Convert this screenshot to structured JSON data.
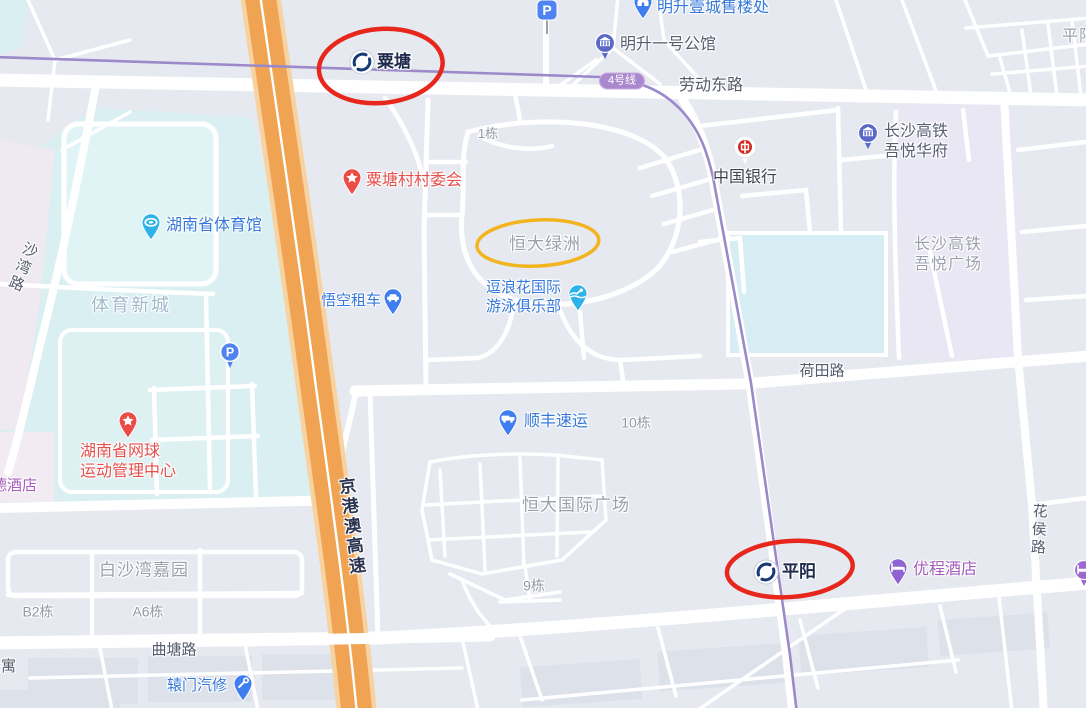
{
  "metro": {
    "line_badge": {
      "text": "4号线",
      "x": 622,
      "y": 81
    },
    "stations": [
      {
        "id": "station-sutang",
        "name": "粟塘",
        "icon_x": 362,
        "icon_y": 62,
        "text_x": 377,
        "text_y": 51,
        "fs": 17
      },
      {
        "id": "station-pingyang",
        "name": "平阳",
        "icon_x": 766,
        "icon_y": 572,
        "text_x": 782,
        "text_y": 561,
        "fs": 17
      }
    ]
  },
  "labels": [
    {
      "id": "road-laodongdonglu",
      "text": "劳动东路",
      "x": 711,
      "y": 86,
      "cls": "road",
      "fs": 16,
      "anchor": "center"
    },
    {
      "id": "road-hetianlu",
      "text": "荷田路",
      "x": 822,
      "y": 372,
      "cls": "road",
      "fs": 15,
      "anchor": "center"
    },
    {
      "id": "road-qutanglu",
      "text": "曲塘路",
      "x": 174,
      "y": 651,
      "cls": "road",
      "fs": 15,
      "anchor": "center"
    },
    {
      "id": "road-shawanlu",
      "text": "沙湾路",
      "x": 12,
      "y": 240,
      "cls": "road",
      "fs": 15,
      "vertical": true,
      "rotate": 22
    },
    {
      "id": "road-huahoulu",
      "text": "花侯路",
      "x": 1028,
      "y": 503,
      "cls": "road",
      "fs": 15,
      "vertical": true,
      "rotate": 3
    },
    {
      "id": "road-jinggangao-expressway",
      "text": "京港澳高速",
      "x": 340,
      "y": 477,
      "cls": "hwy",
      "fs": 17,
      "vertical": true,
      "rotate": -7
    },
    {
      "id": "label-gongyu-partial",
      "text": "公寓",
      "x": -14,
      "y": 658,
      "cls": "road",
      "fs": 15
    },
    {
      "id": "area-tiyuxincheng",
      "text": "体育新城",
      "x": 131,
      "y": 305,
      "cls": "sports",
      "fs": 18,
      "anchor": "center"
    },
    {
      "id": "area-baishawan-jiayuan",
      "text": "白沙湾嘉园",
      "x": 144,
      "y": 570,
      "cls": "area",
      "fs": 17,
      "anchor": "center"
    },
    {
      "id": "area-hengda-lvzhou",
      "text": "恒大绿洲",
      "x": 545,
      "y": 244,
      "cls": "area",
      "fs": 17,
      "anchor": "center"
    },
    {
      "id": "area-hengda-guoji-guangchang",
      "text": "恒大国际广场",
      "x": 576,
      "y": 505,
      "cls": "area",
      "fs": 17,
      "anchor": "center"
    },
    {
      "id": "area-changsha-gaotie-wuyue-guangchang",
      "lines": [
        "长沙高铁",
        "吾悦广场"
      ],
      "x": 948,
      "y": 255,
      "cls": "area",
      "fs": 16,
      "anchor": "center"
    },
    {
      "id": "area-pingyang-partial",
      "text": "平阳",
      "x": 1062,
      "y": 27,
      "cls": "area",
      "fs": 16
    },
    {
      "id": "bld-1dong",
      "text": "1栋",
      "x": 488,
      "y": 134,
      "cls": "bld",
      "fs": 13,
      "anchor": "center"
    },
    {
      "id": "bld-10dong",
      "text": "10栋",
      "x": 636,
      "y": 423,
      "cls": "bld",
      "fs": 14,
      "anchor": "center"
    },
    {
      "id": "bld-9dong",
      "text": "9栋",
      "x": 534,
      "y": 586,
      "cls": "bld",
      "fs": 14,
      "anchor": "center"
    },
    {
      "id": "bld-b2dong",
      "text": "B2栋",
      "x": 38,
      "y": 612,
      "cls": "bld",
      "fs": 14,
      "anchor": "center"
    },
    {
      "id": "bld-a6dong",
      "text": "A6栋",
      "x": 148,
      "y": 612,
      "cls": "bld",
      "fs": 14,
      "anchor": "center"
    },
    {
      "id": "poi-dejiudian-partial",
      "text": "德酒店",
      "x": -8,
      "y": 477,
      "cls": "poi-purple",
      "fs": 15
    }
  ],
  "pois": [
    {
      "id": "poi-mingsheng-yicheng-sales",
      "name": "明升壹城售楼处",
      "icon": "house",
      "pin": "td-blue",
      "ix": 643,
      "iy": 2,
      "tx": 657,
      "ty": -2,
      "cls": "poi-blue",
      "fs": 16
    },
    {
      "id": "poi-mingsheng-yihao-gongguan",
      "name": "明升一号公馆",
      "icon": "building",
      "pin": "cp-indigo",
      "ix": 605,
      "iy": 43,
      "tx": 620,
      "ty": 35,
      "cls": "poi-muted",
      "fs": 16
    },
    {
      "id": "poi-bank-of-china",
      "name": "中国银行",
      "icon": "boc",
      "pin": "bank",
      "ix": 745,
      "iy": 147,
      "tx": 713,
      "ty": 168,
      "cls": "poi-dark",
      "fs": 16
    },
    {
      "id": "poi-wuyue-huafu",
      "lines": [
        "长沙高铁",
        "吾悦华府"
      ],
      "name": "长沙高铁吾悦华府",
      "icon": "building",
      "pin": "cp-indigo",
      "ix": 868,
      "iy": 133,
      "tx": 884,
      "ty": 122,
      "cls": "poi-muted",
      "fs": 16
    },
    {
      "id": "poi-sutang-village-committee",
      "name": "粟塘村村委会",
      "icon": "star",
      "pin": "td-red",
      "ix": 352,
      "iy": 178,
      "tx": 366,
      "ty": 171,
      "cls": "poi-red",
      "fs": 16
    },
    {
      "id": "poi-hunan-gymnasium",
      "name": "湖南省体育馆",
      "icon": "stadium",
      "pin": "td-cyan",
      "ix": 151,
      "iy": 223,
      "tx": 166,
      "ty": 216,
      "cls": "poi-blue",
      "fs": 16
    },
    {
      "id": "poi-wukong-car-rental",
      "name": "悟空租车",
      "icon": "car",
      "pin": "td-blue",
      "ix": 393,
      "iy": 298,
      "tx": 321,
      "ty": 292,
      "cls": "poi-blue",
      "fs": 15
    },
    {
      "id": "poi-doulanghua-swim-club",
      "lines": [
        "逗浪花国际",
        "游泳俱乐部"
      ],
      "name": "逗浪花国际游泳俱乐部",
      "icon": "swim",
      "pin": "td-cyan",
      "ix": 578,
      "iy": 294,
      "tx": 486,
      "ty": 279,
      "cls": "poi-blue",
      "fs": 15
    },
    {
      "id": "poi-sf-express",
      "name": "顺丰速运",
      "icon": "truck",
      "pin": "td-blue",
      "ix": 508,
      "iy": 419,
      "tx": 524,
      "ty": 412,
      "cls": "poi-blue",
      "fs": 16
    },
    {
      "id": "poi-hunan-tennis-center",
      "lines": [
        "湖南省网球",
        "运动管理中心"
      ],
      "name": "湖南省网球运动管理中心",
      "icon": "star",
      "pin": "td-red",
      "ix": 128,
      "iy": 421,
      "tx": 128,
      "ty": 462,
      "cls": "poi-red",
      "fs": 16,
      "center": true
    },
    {
      "id": "poi-youcheng-hotel",
      "name": "优程酒店",
      "icon": "bed",
      "pin": "td-purple",
      "ix": 898,
      "iy": 568,
      "tx": 913,
      "ty": 560,
      "cls": "poi-purple",
      "fs": 16
    },
    {
      "id": "poi-yuanmen-auto-repair",
      "name": "辕门汽修",
      "icon": "tools",
      "pin": "td-blue",
      "ix": 243,
      "iy": 684,
      "tx": 167,
      "ty": 677,
      "cls": "poi-blue",
      "fs": 15
    },
    {
      "id": "poi-hotel-pin-partial",
      "name": "",
      "icon": "bed",
      "pin": "cp-purple",
      "ix": 1084,
      "iy": 570
    },
    {
      "id": "poi-parking-north",
      "name": "P",
      "icon": "p",
      "pin": "psign",
      "ix": 547,
      "iy": 10
    },
    {
      "id": "poi-parking-sports",
      "name": "P",
      "icon": "p",
      "pin": "pround",
      "ix": 230,
      "iy": 352
    }
  ],
  "annotations": [
    {
      "id": "annotation-red-ellipse-sutang",
      "cx": 381,
      "cy": 66,
      "rx": 62,
      "ry": 37,
      "rot": -5,
      "color": "#e7261c",
      "sw": 4.5
    },
    {
      "id": "annotation-red-ellipse-pingyang",
      "cx": 790,
      "cy": 569,
      "rx": 63,
      "ry": 28,
      "rot": -4,
      "color": "#e7261c",
      "sw": 4.5
    },
    {
      "id": "annotation-yellow-ellipse-hengda",
      "cx": 538,
      "cy": 243,
      "rx": 61,
      "ry": 23,
      "rot": -3,
      "color": "#f2b41f",
      "sw": 3.5
    }
  ]
}
